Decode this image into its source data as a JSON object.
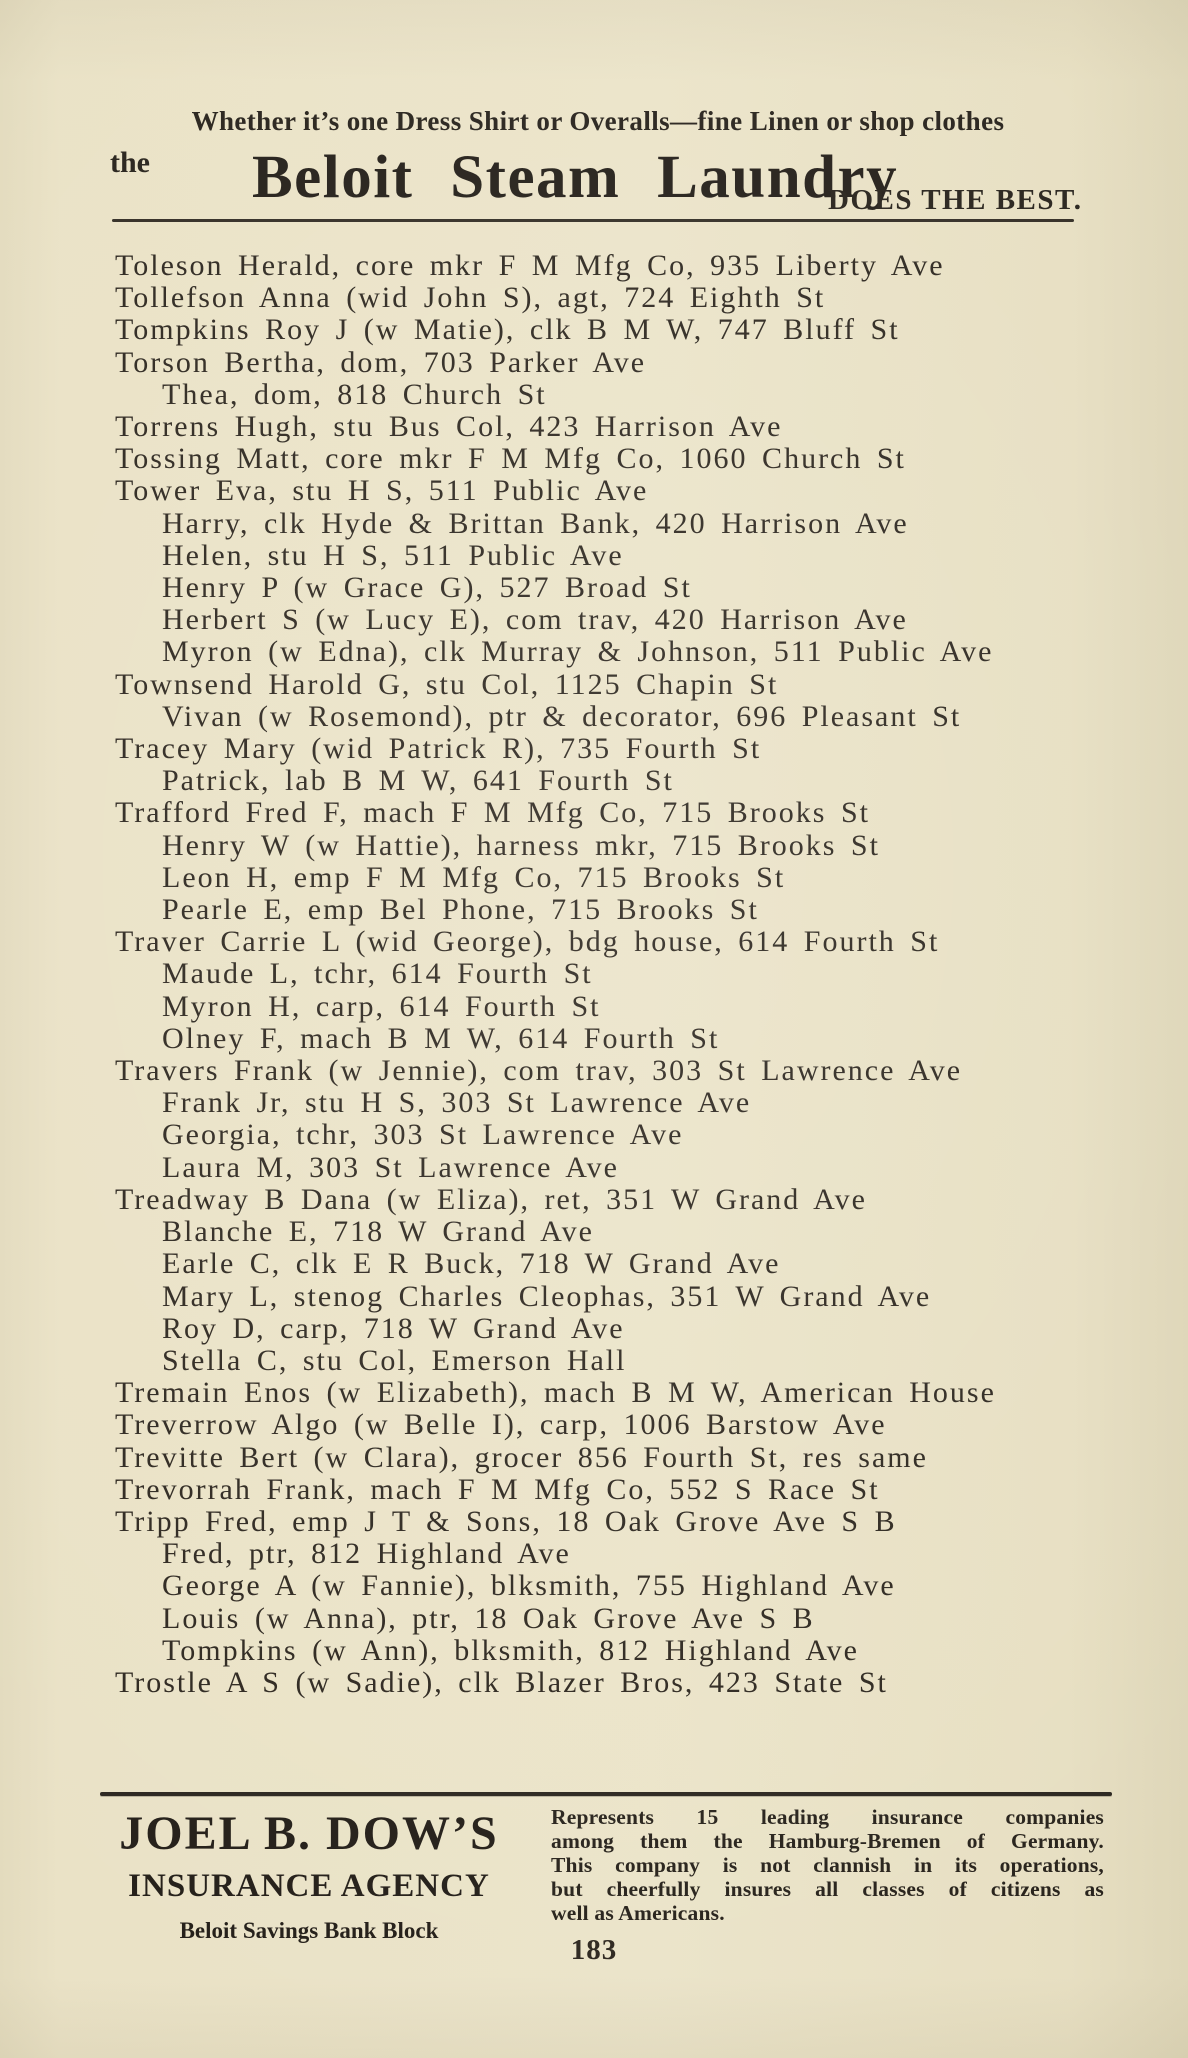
{
  "top_ad": {
    "tagline": "Whether it’s one Dress Shirt or Overalls—fine Linen or shop clothes",
    "prefix": "the",
    "brand": "Beloit Steam Laundry",
    "claim": "DOES THE BEST."
  },
  "directory": {
    "entries": [
      {
        "indent": false,
        "text": "Toleson Herald, core mkr F M Mfg Co, 935 Liberty Ave"
      },
      {
        "indent": false,
        "text": "Tollefson Anna (wid John S), agt, 724 Eighth St"
      },
      {
        "indent": false,
        "text": "Tompkins Roy J (w Matie), clk B M W, 747 Bluff St"
      },
      {
        "indent": false,
        "text": "Torson Bertha, dom, 703 Parker Ave"
      },
      {
        "indent": true,
        "text": "Thea, dom, 818 Church St"
      },
      {
        "indent": false,
        "text": "Torrens Hugh, stu Bus Col, 423 Harrison Ave"
      },
      {
        "indent": false,
        "text": "Tossing Matt, core mkr F M Mfg Co, 1060 Church St"
      },
      {
        "indent": false,
        "text": "Tower Eva, stu H S, 511 Public Ave"
      },
      {
        "indent": true,
        "text": "Harry, clk Hyde & Brittan Bank, 420 Harrison Ave"
      },
      {
        "indent": true,
        "text": "Helen, stu H S, 511 Public Ave"
      },
      {
        "indent": true,
        "text": "Henry P (w Grace G), 527 Broad St"
      },
      {
        "indent": true,
        "text": "Herbert S (w Lucy E), com trav, 420 Harrison Ave"
      },
      {
        "indent": true,
        "text": "Myron (w Edna), clk Murray & Johnson, 511 Public Ave"
      },
      {
        "indent": false,
        "text": "Townsend Harold G, stu Col, 1125 Chapin St"
      },
      {
        "indent": true,
        "text": "Vivan (w Rosemond), ptr & decorator, 696 Pleasant St"
      },
      {
        "indent": false,
        "text": "Tracey Mary (wid Patrick R), 735 Fourth St"
      },
      {
        "indent": true,
        "text": "Patrick, lab B M W, 641 Fourth St"
      },
      {
        "indent": false,
        "text": "Trafford Fred F, mach F M Mfg Co, 715 Brooks St"
      },
      {
        "indent": true,
        "text": "Henry W (w Hattie), harness mkr, 715 Brooks St"
      },
      {
        "indent": true,
        "text": "Leon H, emp F M Mfg Co, 715 Brooks St"
      },
      {
        "indent": true,
        "text": "Pearle E, emp Bel Phone, 715 Brooks St"
      },
      {
        "indent": false,
        "text": "Traver Carrie L (wid George), bdg house, 614 Fourth St"
      },
      {
        "indent": true,
        "text": "Maude L, tchr, 614 Fourth St"
      },
      {
        "indent": true,
        "text": "Myron H, carp, 614 Fourth St"
      },
      {
        "indent": true,
        "text": "Olney F, mach B M W, 614 Fourth St"
      },
      {
        "indent": false,
        "text": "Travers Frank (w Jennie), com trav, 303 St Lawrence Ave"
      },
      {
        "indent": true,
        "text": "Frank Jr, stu H S, 303 St Lawrence Ave"
      },
      {
        "indent": true,
        "text": "Georgia, tchr, 303 St Lawrence Ave"
      },
      {
        "indent": true,
        "text": "Laura M, 303 St Lawrence Ave"
      },
      {
        "indent": false,
        "text": "Treadway B Dana (w Eliza), ret, 351 W Grand Ave"
      },
      {
        "indent": true,
        "text": "Blanche E, 718 W Grand Ave"
      },
      {
        "indent": true,
        "text": "Earle C, clk E R Buck, 718 W Grand Ave"
      },
      {
        "indent": true,
        "text": "Mary L, stenog Charles Cleophas, 351 W Grand Ave"
      },
      {
        "indent": true,
        "text": "Roy D, carp, 718 W Grand Ave"
      },
      {
        "indent": true,
        "text": "Stella C, stu Col, Emerson Hall"
      },
      {
        "indent": false,
        "text": "Tremain Enos (w Elizabeth), mach B M W, American House"
      },
      {
        "indent": false,
        "text": "Treverrow Algo (w Belle I), carp, 1006 Barstow Ave"
      },
      {
        "indent": false,
        "text": "Trevitte Bert (w Clara), grocer 856 Fourth St, res same"
      },
      {
        "indent": false,
        "text": "Trevorrah Frank, mach F M Mfg Co, 552 S Race St"
      },
      {
        "indent": false,
        "text": "Tripp Fred, emp J T & Sons, 18 Oak Grove Ave S B"
      },
      {
        "indent": true,
        "text": "Fred, ptr, 812 Highland Ave"
      },
      {
        "indent": true,
        "text": "George A (w Fannie), blksmith, 755 Highland Ave"
      },
      {
        "indent": true,
        "text": "Louis (w Anna), ptr, 18 Oak Grove Ave S B"
      },
      {
        "indent": true,
        "text": "Tompkins (w Ann), blksmith, 812 Highland Ave"
      },
      {
        "indent": false,
        "text": "Trostle A S (w Sadie), clk Blazer Bros, 423 State St"
      }
    ]
  },
  "bottom_ad": {
    "title": "JOEL B. DOW’S",
    "subtitle": "INSURANCE AGENCY",
    "location": "Beloit Savings Bank Block",
    "description_lines": [
      "Represents 15 leading insurance companies",
      "among them the Hamburg-Bremen of Germany.",
      "This company is not clannish in its operations,",
      "but cheerfully insures all classes of citizens as",
      "well as Americans."
    ]
  },
  "page": {
    "number": "183"
  }
}
